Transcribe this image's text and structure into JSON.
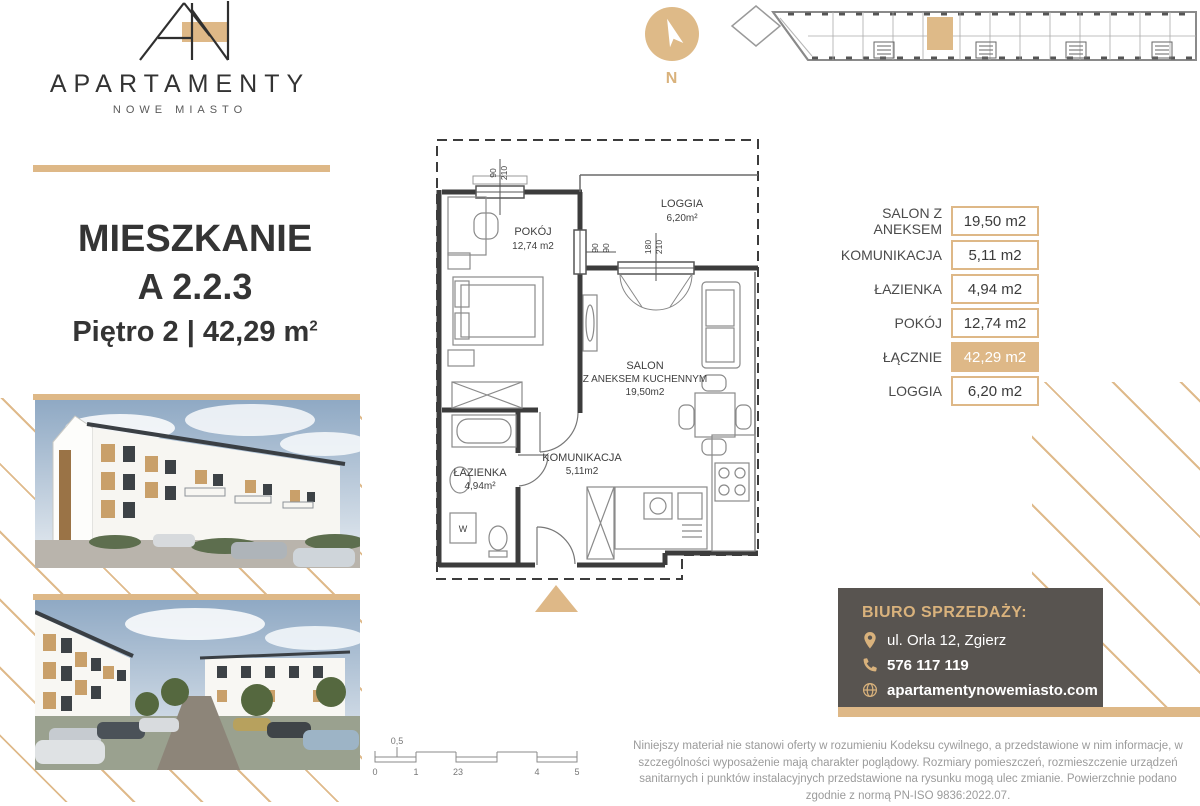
{
  "brand": {
    "title": "APARTAMENTY",
    "subtitle": "NOWE MIASTO"
  },
  "apartment": {
    "heading": "MIESZKANIE",
    "unit": "A 2.2.3",
    "floor_line": "Piętro 2 | 42,29 m",
    "floor_sup": "2"
  },
  "compass": {
    "north": "N"
  },
  "floor_plan": {
    "rooms": {
      "pokoj": {
        "name": "POKÓJ",
        "area": "12,74 m2"
      },
      "loggia": {
        "name": "LOGGIA",
        "area": "6,20m²"
      },
      "salon": {
        "name": "SALON",
        "name2": "Z ANEKSEM KUCHENNYM",
        "area": "19,50m2"
      },
      "komunikacja": {
        "name": "KOMUNIKACJA",
        "area": "5,11m2"
      },
      "lazienka": {
        "name": "ŁAZIENKA",
        "area": "4,94m²"
      }
    },
    "dims": {
      "window1": [
        "90",
        "210"
      ],
      "window2": [
        "90",
        "90"
      ],
      "window3": [
        "180",
        "210"
      ]
    },
    "washer": "W"
  },
  "area_table": {
    "rows": [
      {
        "label": "SALON Z ANEKSEM",
        "value": "19,50 m2"
      },
      {
        "label": "KOMUNIKACJA",
        "value": "5,11 m2"
      },
      {
        "label": "ŁAZIENKA",
        "value": "4,94 m2"
      },
      {
        "label": "POKÓJ",
        "value": "12,74 m2"
      },
      {
        "label": "ŁĄCZNIE",
        "value": "42,29 m2"
      },
      {
        "label": "LOGGIA",
        "value": "6,20 m2"
      }
    ]
  },
  "contact": {
    "heading": "BIURO SPRZEDAŻY:",
    "address": "ul. Orla 12, Zgierz",
    "phone": "576 117 119",
    "website": "apartamentynowemiasto.com"
  },
  "disclaimer": "Niniejszy materiał nie stanowi oferty w rozumieniu Kodeksu cywilnego, a przedstawione w nim informacje, w szczególności wyposażenie mają charakter poglądowy. Rozmiary pomieszczeń, rozmieszczenie urządzeń sanitarnych i punktów instalacyjnych przedstawione na rysunku mogą ulec zmianie. Powierzchnie podano zgodnie z normą PN-ISO 9836:2022.07.",
  "scale_bar": {
    "labels": [
      "0",
      "1",
      "23",
      "4",
      "5"
    ],
    "half": "0,5"
  },
  "colors": {
    "gold": "#deb887",
    "dark_box": "#585450"
  }
}
